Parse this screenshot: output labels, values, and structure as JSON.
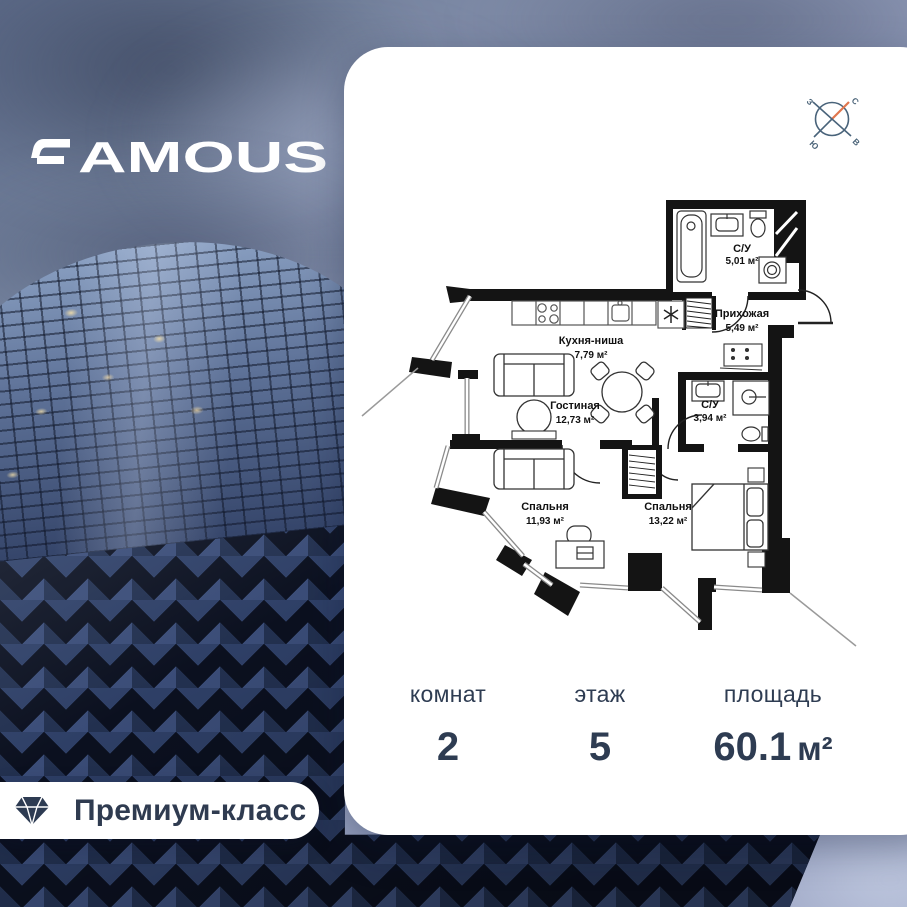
{
  "brand": {
    "name": "FAMOUS",
    "wordmark_rest": "AMOUS"
  },
  "badge": {
    "label": "Премиум-класс"
  },
  "compass": {
    "north": "С",
    "east": "В",
    "south": "Ю",
    "west": "З"
  },
  "plan": {
    "rooms": [
      {
        "name": "Кухня-ниша",
        "area": "7,79 м²"
      },
      {
        "name": "Гостиная",
        "area": "12,73 м²"
      },
      {
        "name": "Прихожая",
        "area": "5,49 м²"
      },
      {
        "name": "С/У",
        "area": "5,01 м²"
      },
      {
        "name": "С/У",
        "area": "3,94 м²"
      },
      {
        "name": "Спальня",
        "area": "11,93 м²"
      },
      {
        "name": "Спальня",
        "area": "13,22 м²"
      }
    ]
  },
  "stats": {
    "rooms": {
      "label": "комнат",
      "value": "2"
    },
    "floor": {
      "label": "этаж",
      "value": "5"
    },
    "area": {
      "label": "площадь",
      "value": "60.1",
      "unit": "м²"
    }
  },
  "colors": {
    "accent_text": "#2e3c52",
    "compass_needle": "#e0764e",
    "card_bg": "#ffffff"
  }
}
